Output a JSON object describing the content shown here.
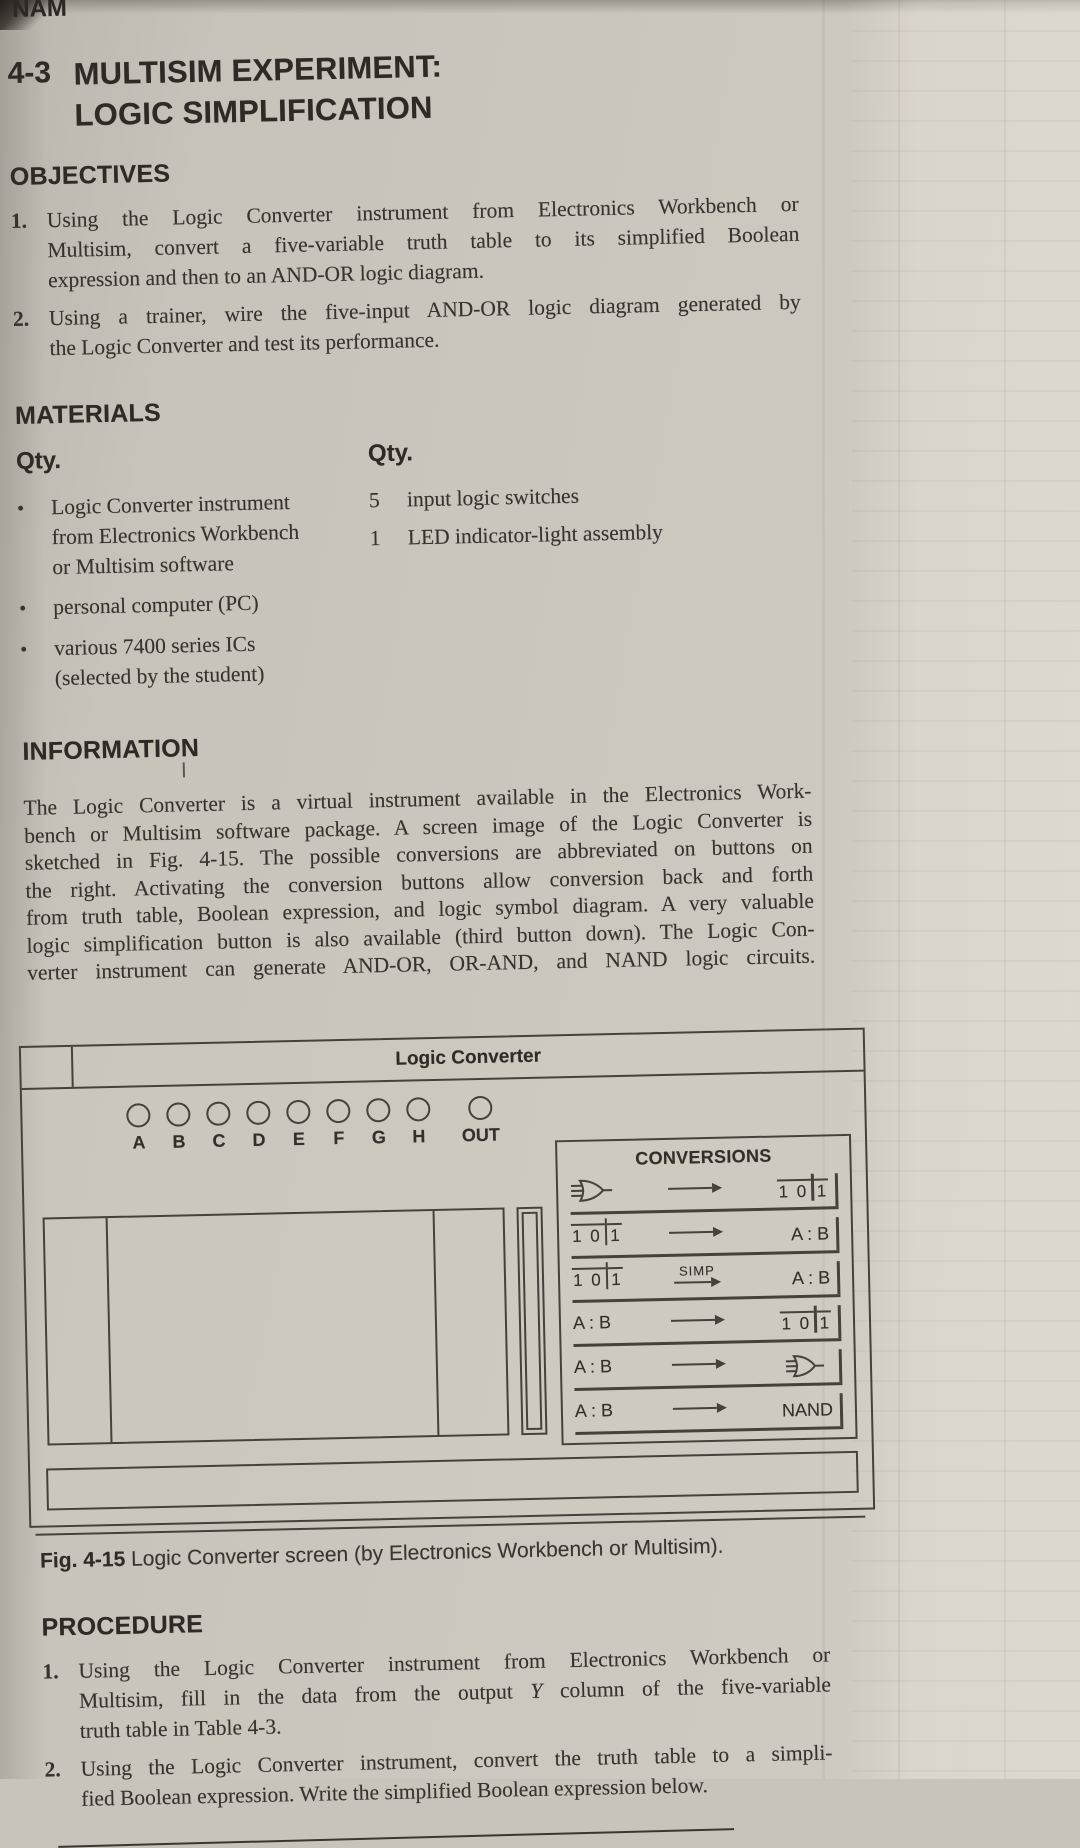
{
  "theme": {
    "paper": "#c9c5bc",
    "ink": "#35302b",
    "line": "#48423b"
  },
  "page": {
    "header_partial": "NAM"
  },
  "title": {
    "number": "4-3",
    "line1": "MULTISIM EXPERIMENT:",
    "line2": "LOGIC SIMPLIFICATION"
  },
  "objectives": {
    "heading": "OBJECTIVES",
    "items": [
      {
        "number": "1.",
        "lines": [
          "Using the Logic Converter instrument from Electronics Workbench or",
          "Multisim, convert a five-variable truth table to its simplified Boolean",
          "expression and then to an AND-OR logic diagram."
        ]
      },
      {
        "number": "2.",
        "lines": [
          "Using a trainer, wire the five-input AND-OR logic diagram generated by",
          "the Logic Converter and test its performance."
        ]
      }
    ]
  },
  "materials": {
    "heading": "MATERIALS",
    "bullet": "•",
    "left": {
      "qty_label": "Qty.",
      "items": [
        {
          "lines": [
            "Logic Converter instrument",
            "from Electronics Workbench",
            "or Multisim software"
          ]
        },
        {
          "lines": [
            "personal computer (PC)"
          ]
        },
        {
          "lines": [
            "various 7400 series ICs",
            "(selected by the student)"
          ]
        }
      ]
    },
    "right": {
      "qty_label": "Qty.",
      "rows": [
        {
          "qty": "5",
          "text": "input logic switches"
        },
        {
          "qty": "1",
          "text": "LED indicator-light assembly"
        }
      ]
    }
  },
  "information": {
    "heading": "INFORMATION",
    "lines": [
      "The Logic Converter is a virtual instrument available in the Electronics Work-",
      "bench or Multisim software package. A screen image of the Logic Converter is",
      "sketched in Fig. 4-15. The possible conversions are abbreviated on buttons on",
      "the right. Activating the conversion buttons allow conversion back and forth",
      "from truth table, Boolean expression, and logic symbol diagram. A very valuable",
      "logic simplification button is also available (third button down). The Logic Con-",
      "verter instrument can generate AND-OR, OR-AND, and NAND logic circuits."
    ]
  },
  "figure": {
    "window_title": "Logic Converter",
    "terminals": [
      "A",
      "B",
      "C",
      "D",
      "E",
      "F",
      "G",
      "H"
    ],
    "out_label": "OUT",
    "conversions": {
      "heading": "CONVERSIONS",
      "tt_icon_text": {
        "a": "1 0",
        "b": "1"
      },
      "simp_label": "SIMP",
      "rows": [
        {
          "left": "gate-icon",
          "arrow_label": "",
          "right": "tt-icon"
        },
        {
          "left": "tt-icon",
          "arrow_label": "",
          "right": "A : B"
        },
        {
          "left": "tt-icon",
          "arrow_label": "SIMP",
          "right": "A : B"
        },
        {
          "left": "A : B",
          "arrow_label": "",
          "right": "tt-icon"
        },
        {
          "left": "A : B",
          "arrow_label": "",
          "right": "gate-icon"
        },
        {
          "left": "A : B",
          "arrow_label": "",
          "right": "NAND"
        }
      ]
    },
    "caption": {
      "label": "Fig. 4-15",
      "text": "Logic Converter screen (by Electronics Workbench or Multisim)."
    }
  },
  "procedure": {
    "heading": "PROCEDURE",
    "items": [
      {
        "number": "1.",
        "line1": "Using the Logic Converter instrument from Electronics Workbench or",
        "line2_pre": "Multisim, fill in the data from the output ",
        "line2_var": "Y",
        "line2_post": " column of the five-variable",
        "line3": "truth table in Table 4-3."
      },
      {
        "number": "2.",
        "lines": [
          "Using the Logic Converter instrument, convert the truth table to a simpli-",
          "fied Boolean expression. Write the simplified Boolean expression below."
        ]
      }
    ]
  }
}
